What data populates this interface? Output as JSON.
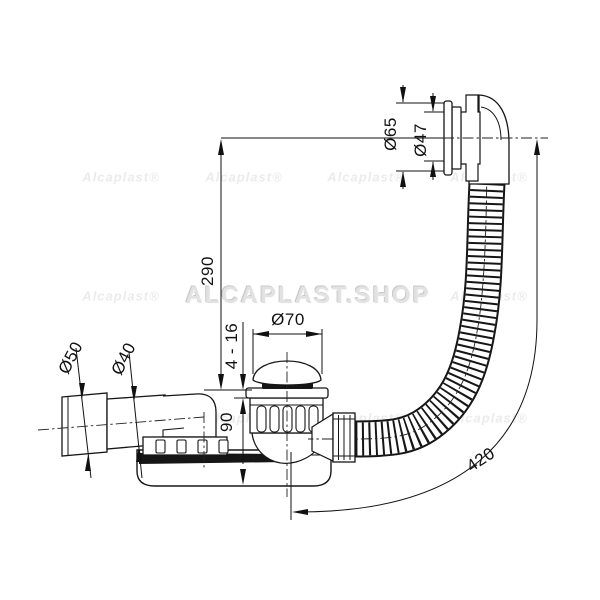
{
  "dims": {
    "overflow_flange": "Ø65",
    "overflow_pipe": "Ø47",
    "overflow_height": "290",
    "plug_cap": "Ø70",
    "plug_lift": "4 - 16",
    "trap_height": "90",
    "outlet_end": "Ø50",
    "outlet_pipe": "Ø40",
    "hose_length": "420"
  },
  "watermarks": {
    "shop": "ALCAPLAST.SHOP",
    "brand": "Alcaplast®"
  },
  "colors": {
    "line": "#161616",
    "dark_fill": "#161616",
    "watermark_main": "#e2e2e2"
  }
}
